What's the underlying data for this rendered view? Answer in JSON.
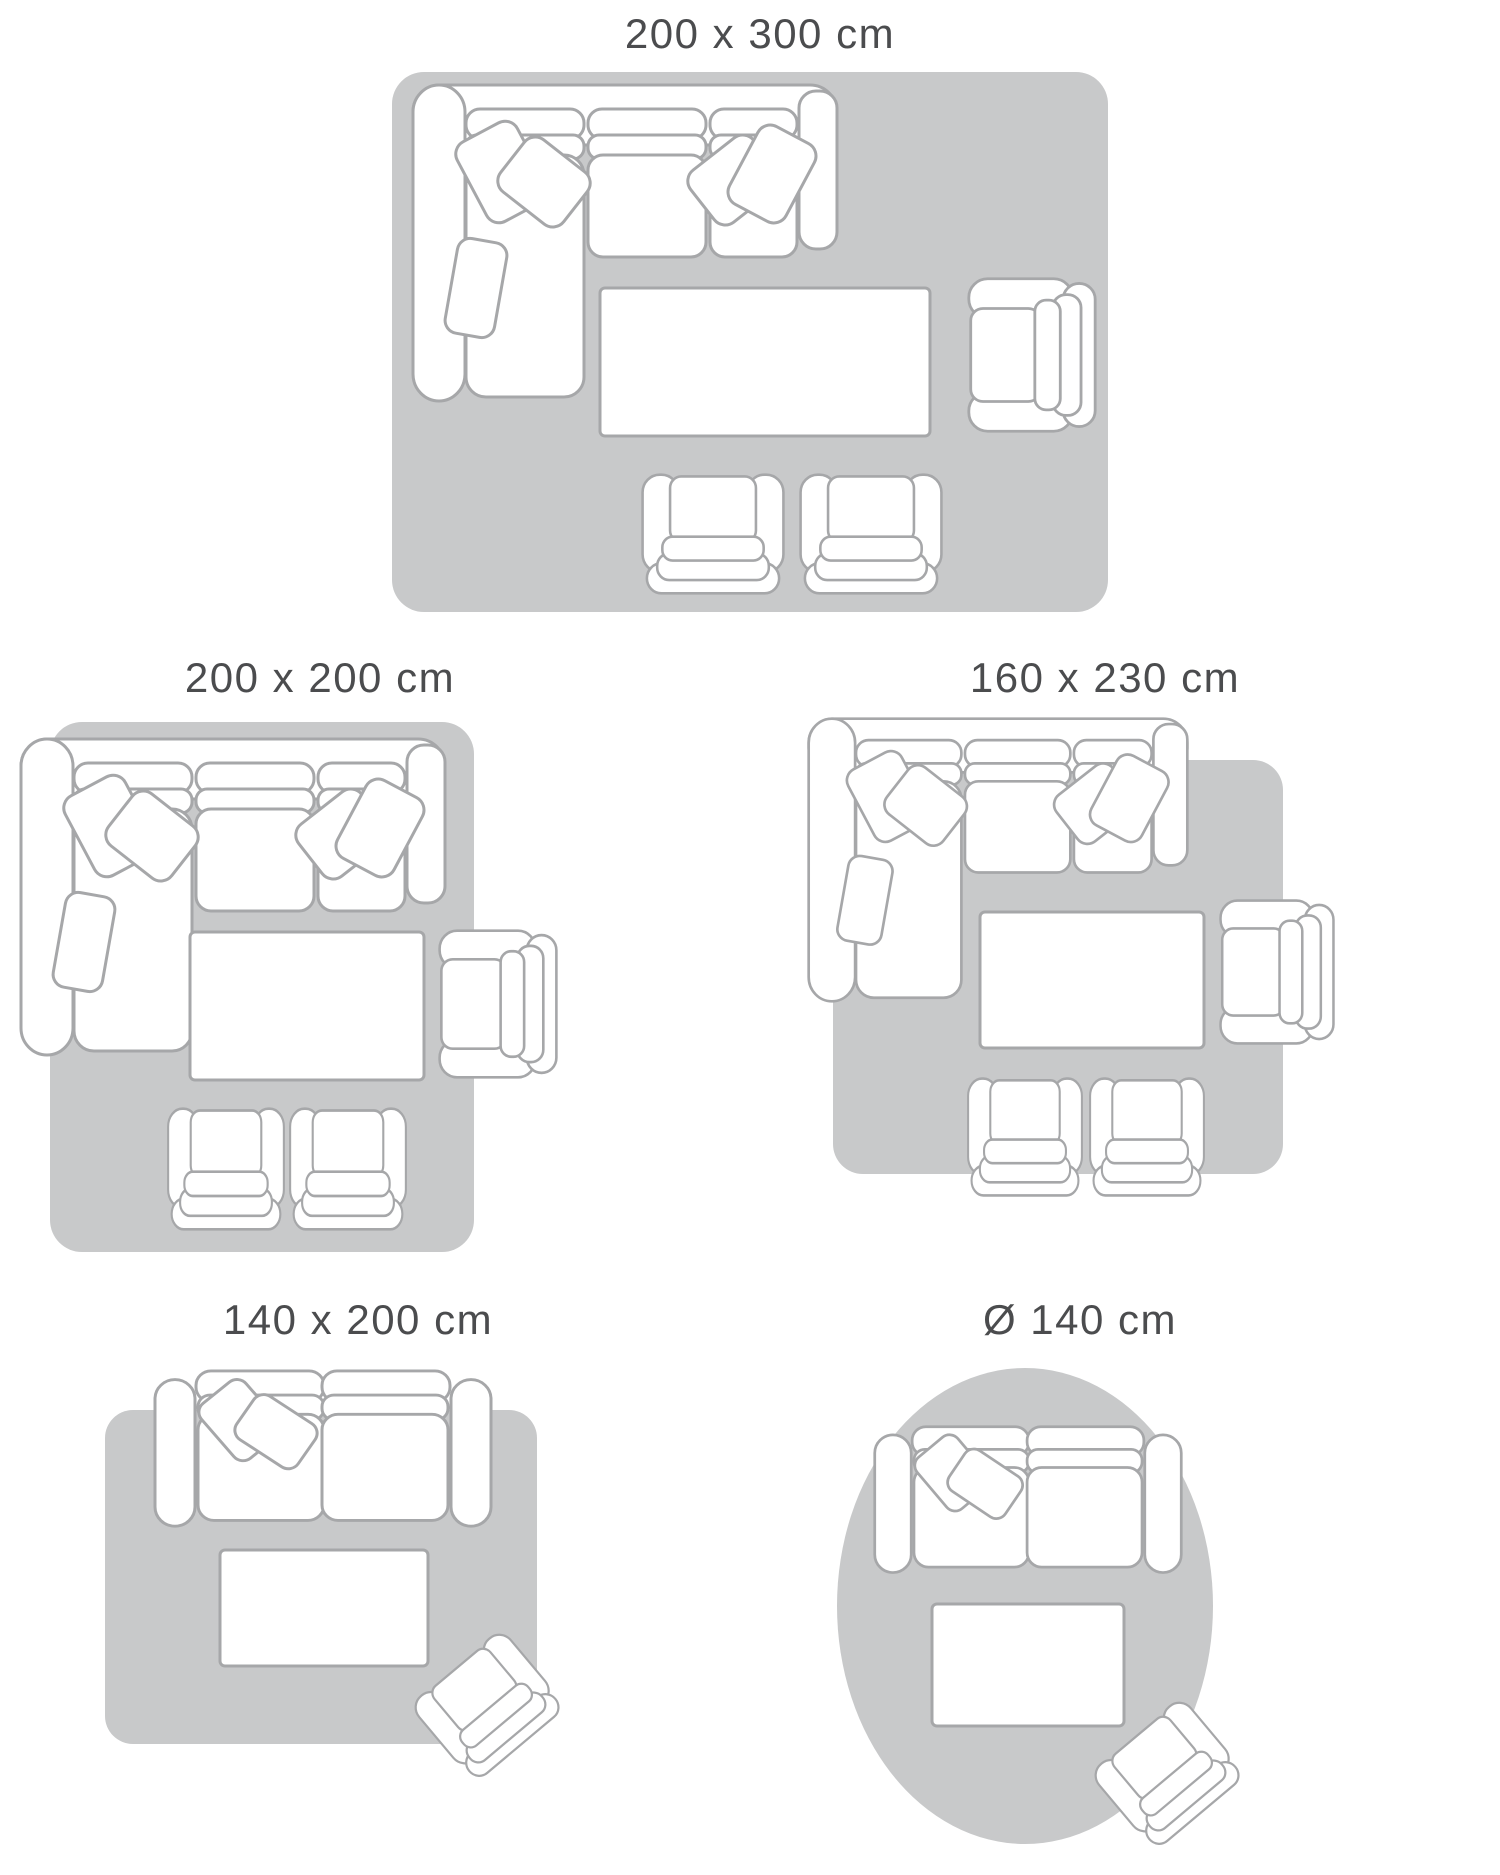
{
  "page_type": "rug-size-guide-diagram",
  "colors": {
    "rug_fill": "#c8c9ca",
    "furniture_outline": "#a6a7a9",
    "furniture_fill": "#ffffff",
    "label_text": "#4b4c4e",
    "background": "#ffffff"
  },
  "panels": [
    {
      "id": "200x300",
      "label": "200 x 300 cm",
      "rug_shape": "rectangle",
      "furniture": [
        "sectional-sofa-icon",
        "coffee-table-icon",
        "armchair-icon",
        "armchair-icon",
        "armchair-icon"
      ]
    },
    {
      "id": "200x200",
      "label": "200 x 200 cm",
      "rug_shape": "rectangle",
      "furniture": [
        "sectional-sofa-icon",
        "coffee-table-icon",
        "armchair-icon",
        "armchair-icon",
        "armchair-icon"
      ]
    },
    {
      "id": "160x230",
      "label": "160 x 230 cm",
      "rug_shape": "rectangle",
      "furniture": [
        "sectional-sofa-icon",
        "coffee-table-icon",
        "armchair-icon",
        "armchair-icon",
        "armchair-icon"
      ]
    },
    {
      "id": "140x200",
      "label": "140 x 200 cm",
      "rug_shape": "rectangle",
      "furniture": [
        "loveseat-sofa-icon",
        "coffee-table-icon",
        "armchair-icon"
      ]
    },
    {
      "id": "d140",
      "label": "Ø 140 cm",
      "rug_shape": "circle",
      "furniture": [
        "loveseat-sofa-icon",
        "coffee-table-icon",
        "armchair-icon"
      ]
    }
  ]
}
